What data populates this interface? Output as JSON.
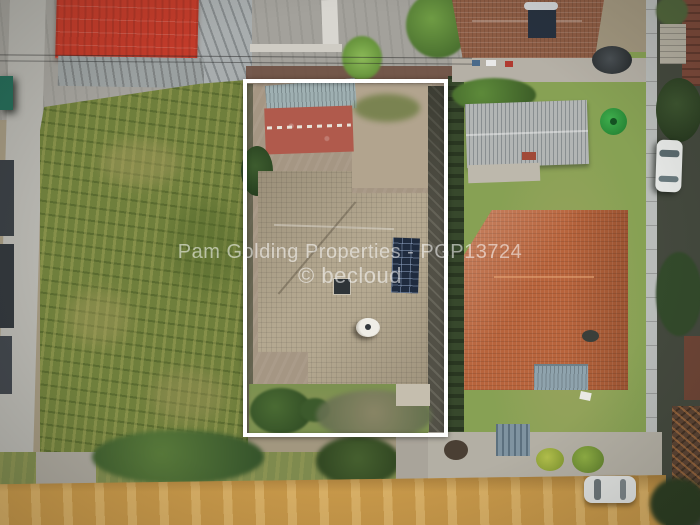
{
  "photo": {
    "type": "aerial-drone-photograph",
    "watermark_line1": "Pam Golding Properties - PGP13724",
    "watermark_line2": "© becloud"
  },
  "colors": {
    "boundary_outline": "#ffffff",
    "red_warehouse_roof": "#c23b2a",
    "main_house_roof": "#b4a890",
    "neighbor_orange_roof": "#b8643c",
    "neighbor_brown_roof": "#8d5c44",
    "garage_grey_roof": "#b2b5b4",
    "crop_field": "#6f7f3c",
    "lawn": "#87a154",
    "dirt_road": "#c69749",
    "solar_panels": "#1f2b3e",
    "green_water_tank": "#2f9e42"
  }
}
